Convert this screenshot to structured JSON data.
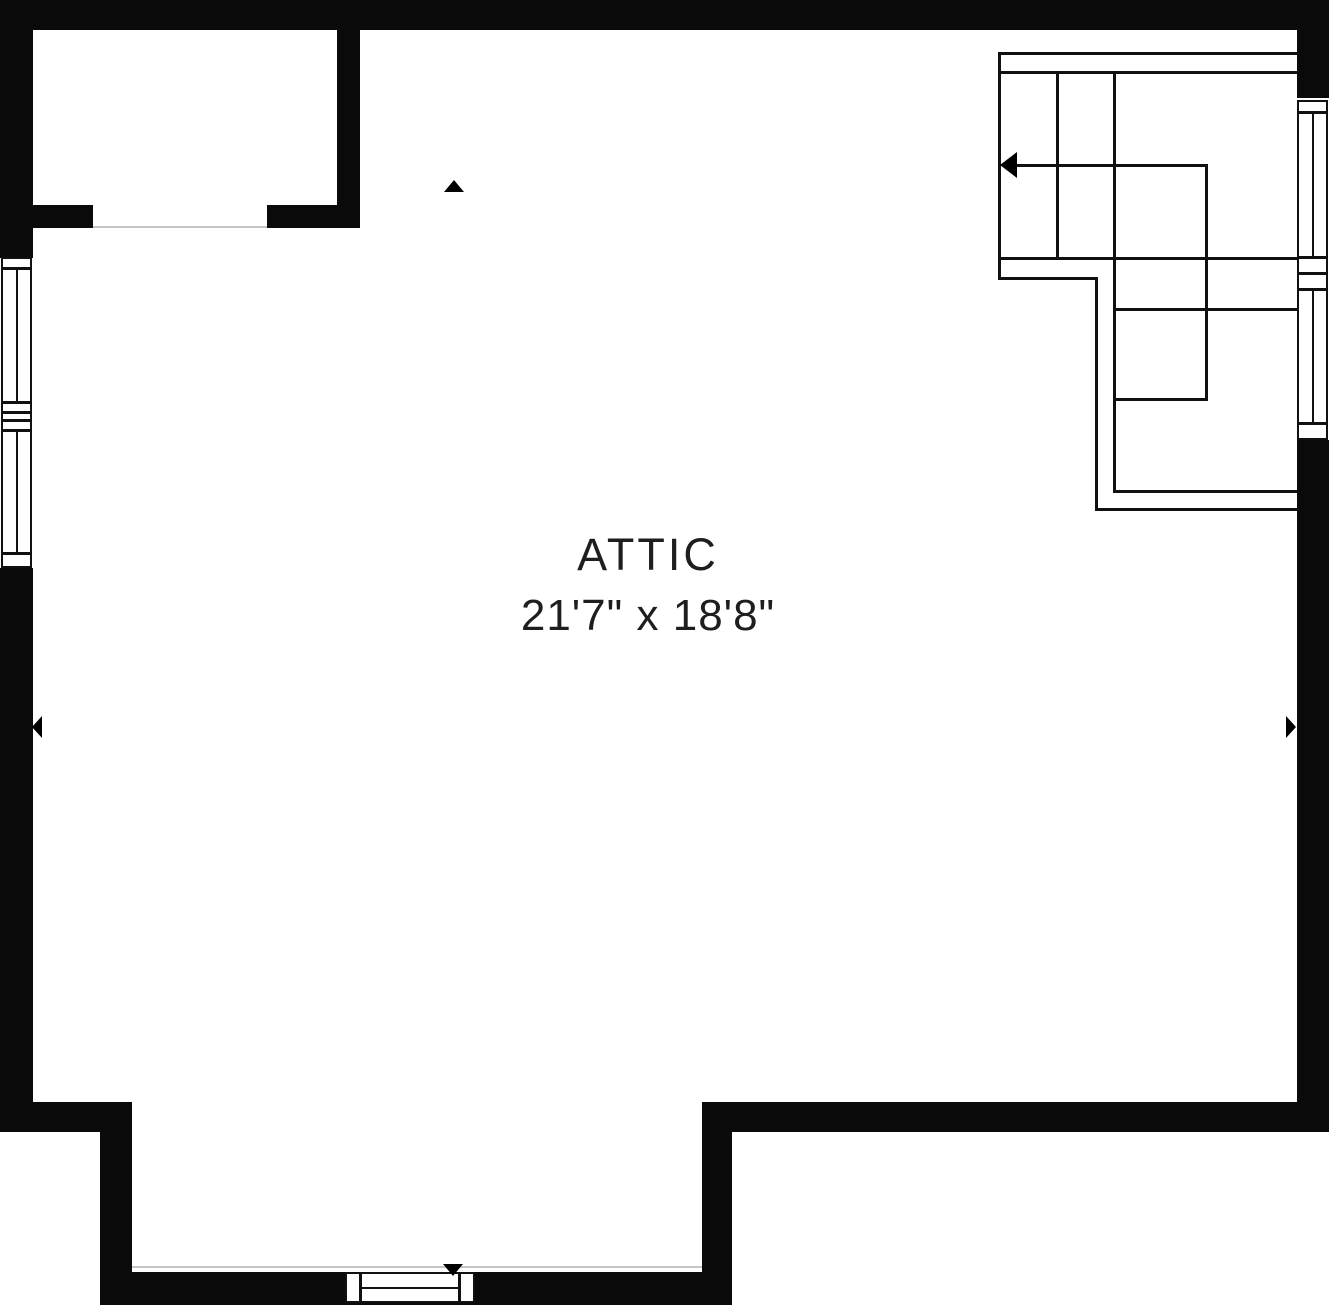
{
  "room": {
    "name": "ATTIC",
    "dimensions": "21'7\" x 18'8\""
  },
  "colors": {
    "wall": "#0a0a0a",
    "line": "#111111",
    "threshold": "#c6c6c6",
    "text": "#1e1e1e",
    "background": "#ffffff"
  },
  "floorplan": {
    "width": 1329,
    "height": 1305,
    "walls": [
      {
        "name": "top-wall",
        "x": 0,
        "y": 0,
        "w": 1329,
        "h": 30
      },
      {
        "name": "left-wall-upper",
        "x": 0,
        "y": 0,
        "w": 33,
        "h": 258
      },
      {
        "name": "left-wall-lower",
        "x": 0,
        "y": 568,
        "w": 33,
        "h": 534
      },
      {
        "name": "left-step-horizontal-wall",
        "x": 0,
        "y": 1102,
        "w": 132,
        "h": 30
      },
      {
        "name": "left-step-vertical-wall",
        "x": 100,
        "y": 1132,
        "w": 32,
        "h": 173
      },
      {
        "name": "bottom-wall",
        "x": 100,
        "y": 1272,
        "w": 602,
        "h": 33
      },
      {
        "name": "right-step-vertical-wall",
        "x": 702,
        "y": 1102,
        "w": 30,
        "h": 203
      },
      {
        "name": "bottom-right-wall",
        "x": 702,
        "y": 1102,
        "w": 627,
        "h": 30
      },
      {
        "name": "right-wall-upper",
        "x": 1297,
        "y": 0,
        "w": 32,
        "h": 98
      },
      {
        "name": "right-wall-lower",
        "x": 1297,
        "y": 440,
        "w": 32,
        "h": 692
      },
      {
        "name": "closet-right-wall",
        "x": 337,
        "y": 30,
        "w": 23,
        "h": 198
      },
      {
        "name": "closet-bottom-wall-left",
        "x": 33,
        "y": 205,
        "w": 60,
        "h": 23
      },
      {
        "name": "closet-bottom-wall-right",
        "x": 267,
        "y": 205,
        "w": 93,
        "h": 23
      }
    ],
    "sills": [
      {
        "name": "left-window-sill-top",
        "x": 1,
        "y": 257,
        "w": 31,
        "h": 12
      },
      {
        "name": "left-window-sill-mid-1",
        "x": 1,
        "y": 402,
        "w": 31,
        "h": 11
      },
      {
        "name": "left-window-sill-mid-2",
        "x": 1,
        "y": 412,
        "w": 31,
        "h": 9
      },
      {
        "name": "left-window-sill-mid-3",
        "x": 1,
        "y": 420,
        "w": 31,
        "h": 11
      },
      {
        "name": "left-window-sill-bottom",
        "x": 1,
        "y": 553,
        "w": 31,
        "h": 15
      },
      {
        "name": "right-window-sill-top",
        "x": 1297,
        "y": 100,
        "w": 31,
        "h": 13
      },
      {
        "name": "right-window-sill-mid-1",
        "x": 1297,
        "y": 257,
        "w": 31,
        "h": 17
      },
      {
        "name": "right-window-sill-mid-2",
        "x": 1297,
        "y": 273,
        "w": 31,
        "h": 17
      },
      {
        "name": "right-window-sill-bottom",
        "x": 1297,
        "y": 423,
        "w": 31,
        "h": 17
      },
      {
        "name": "bottom-window-cap-left",
        "x": 345,
        "y": 1272,
        "w": 16,
        "h": 31
      },
      {
        "name": "bottom-window-cap-right",
        "x": 459,
        "y": 1272,
        "w": 16,
        "h": 31
      }
    ],
    "windows": [
      {
        "name": "left-window-upper",
        "x": 1,
        "y": 268,
        "w": 31,
        "h": 135,
        "orientation": "v"
      },
      {
        "name": "left-window-lower",
        "x": 1,
        "y": 430,
        "w": 31,
        "h": 124,
        "orientation": "v"
      },
      {
        "name": "right-window-upper",
        "x": 1297,
        "y": 112,
        "w": 31,
        "h": 146,
        "orientation": "v"
      },
      {
        "name": "right-window-lower",
        "x": 1297,
        "y": 289,
        "w": 31,
        "h": 135,
        "orientation": "v"
      },
      {
        "name": "bottom-window",
        "x": 360,
        "y": 1272,
        "w": 100,
        "h": 31,
        "orientation": "h"
      }
    ],
    "stair_lines": [
      {
        "name": "stair-top-rail-outer",
        "x": 998,
        "y": 52,
        "w": 299,
        "h": 3
      },
      {
        "name": "stair-top-rail-inner",
        "x": 998,
        "y": 71,
        "w": 299,
        "h": 3
      },
      {
        "name": "stair-left-edge",
        "x": 998,
        "y": 52,
        "w": 3,
        "h": 228
      },
      {
        "name": "stair-tread-1",
        "x": 1056,
        "y": 71,
        "w": 3,
        "h": 189
      },
      {
        "name": "stair-tread-2",
        "x": 1113,
        "y": 71,
        "w": 3,
        "h": 422
      },
      {
        "name": "stair-direction-line",
        "x": 1005,
        "y": 164,
        "w": 203,
        "h": 3
      },
      {
        "name": "stair-center-rail",
        "x": 1205,
        "y": 164,
        "w": 3,
        "h": 237
      },
      {
        "name": "stair-mid-rail",
        "x": 998,
        "y": 257,
        "w": 299,
        "h": 3
      },
      {
        "name": "stair-lower-edge-top",
        "x": 998,
        "y": 277,
        "w": 100,
        "h": 3
      },
      {
        "name": "stair-lower-edge-left",
        "x": 1095,
        "y": 277,
        "w": 3,
        "h": 234
      },
      {
        "name": "stair-bottom-edge",
        "x": 1095,
        "y": 508,
        "w": 202,
        "h": 3
      },
      {
        "name": "stair-landing-top",
        "x": 1113,
        "y": 308,
        "w": 184,
        "h": 3
      },
      {
        "name": "stair-landing-bottom",
        "x": 1113,
        "y": 398,
        "w": 95,
        "h": 3
      },
      {
        "name": "stair-lower-rail",
        "x": 1113,
        "y": 490,
        "w": 184,
        "h": 3
      }
    ],
    "thresholds": [
      {
        "name": "closet-door-threshold",
        "x": 93,
        "y": 226,
        "w": 174,
        "h": 2
      },
      {
        "name": "bottom-wall-face-line",
        "x": 132,
        "y": 1266,
        "w": 570,
        "h": 2
      }
    ],
    "markers": [
      {
        "name": "direction-marker-up-icon",
        "dir": "up",
        "x": 444,
        "y": 180
      },
      {
        "name": "direction-marker-left-icon",
        "dir": "left",
        "x": 32,
        "y": 716
      },
      {
        "name": "direction-marker-right-icon",
        "dir": "right",
        "x": 1286,
        "y": 716
      },
      {
        "name": "direction-marker-down-icon",
        "dir": "down",
        "x": 443,
        "y": 1264
      },
      {
        "name": "stair-arrow-head-icon",
        "dir": "left-large",
        "x": 1000,
        "y": 152
      }
    ]
  }
}
